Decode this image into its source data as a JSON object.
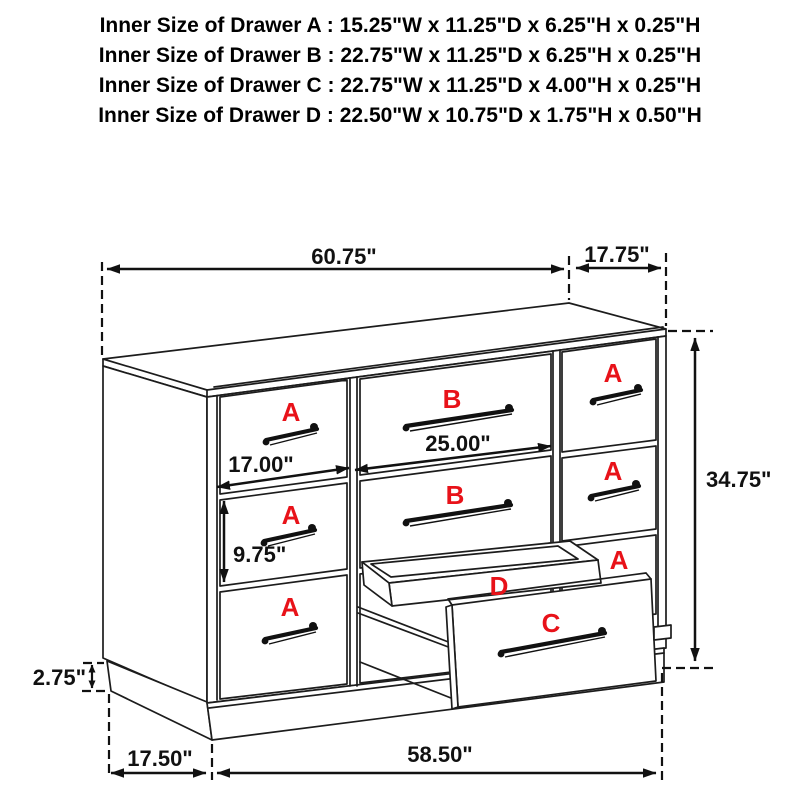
{
  "title_lines": [
    "Inner Size of Drawer A : 15.25\"W x 11.25\"D x 6.25\"H x 0.25\"H",
    "Inner Size of Drawer B : 22.75\"W x 11.25\"D x 6.25\"H x 0.25\"H",
    "Inner Size of Drawer C : 22.75\"W x 11.25\"D x 4.00\"H x 0.25\"H",
    "Inner Size of Drawer  D : 22.50\"W x 10.75\"D x 1.75\"H x 0.50\"H"
  ],
  "diagram": {
    "drawer_labels": {
      "a": "A",
      "b": "B",
      "c": "C",
      "d": "D"
    },
    "dimensions": {
      "top_width": "60.75\"",
      "top_depth": "17.75\"",
      "overall_height": "34.75\"",
      "drawer_a_front_width": "17.00\"",
      "drawer_b_front_width": "25.00\"",
      "drawer_front_height": "9.75\"",
      "base_height": "2.75\"",
      "base_side_inset": "17.50\"",
      "base_front_width": "58.50\""
    },
    "colors": {
      "label_red": "#e81219",
      "line": "#1c1c1c",
      "background": "#ffffff"
    }
  }
}
